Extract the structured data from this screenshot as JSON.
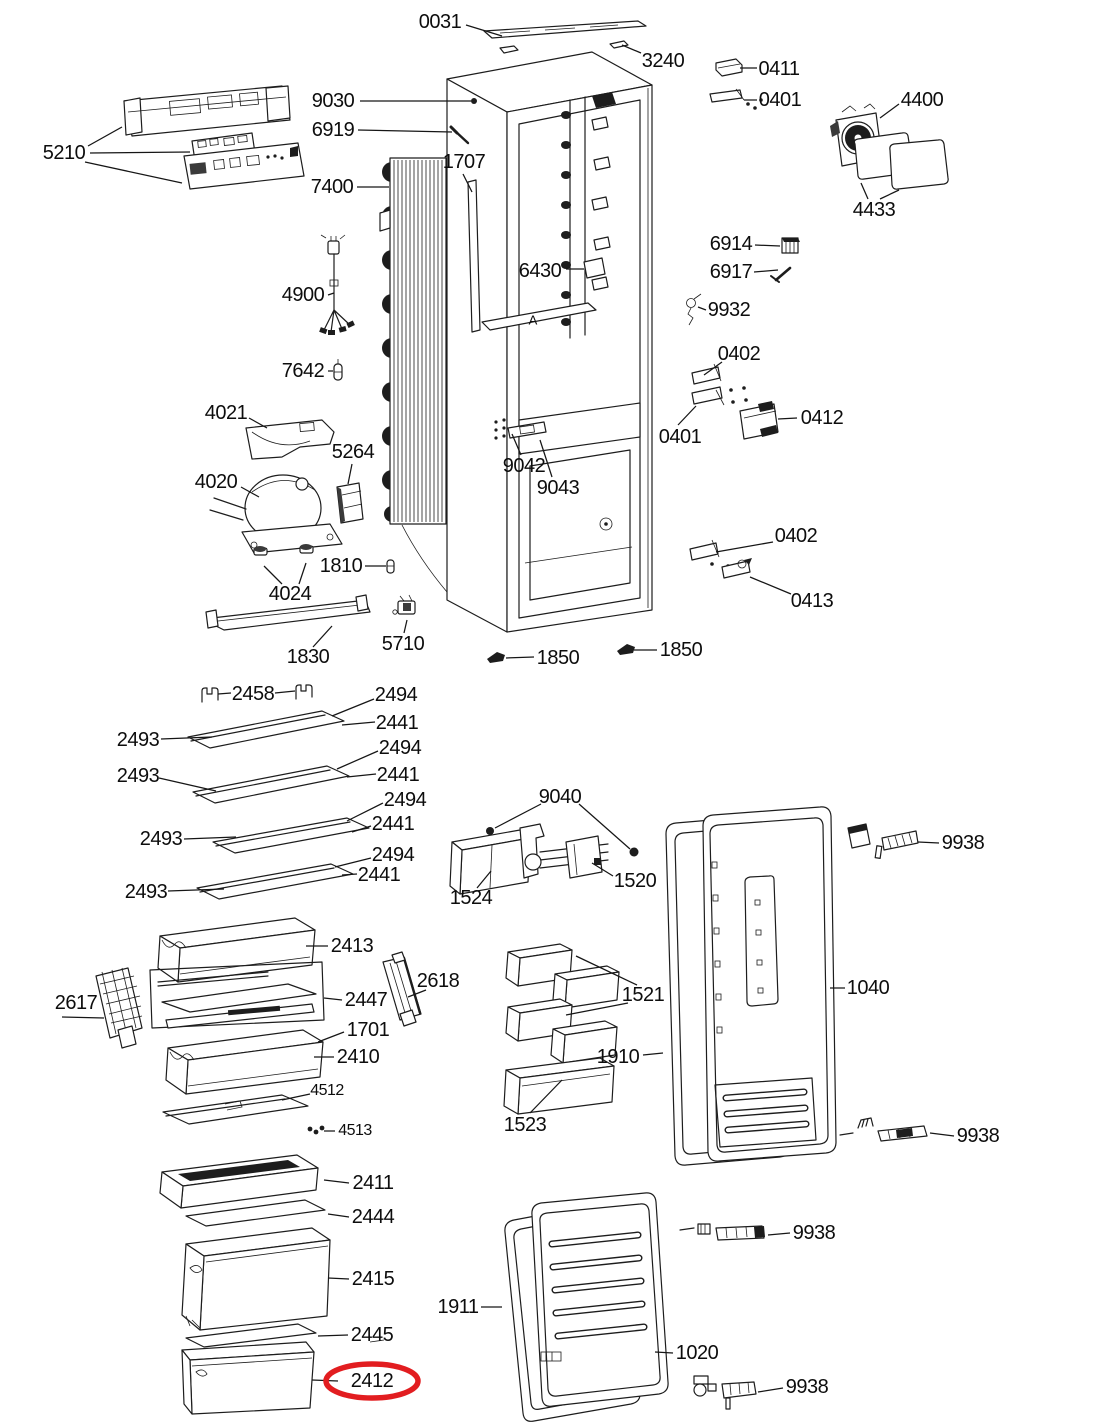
{
  "canvas": {
    "w": 1100,
    "h": 1424,
    "bg": "#ffffff",
    "line_color": "#1d1d1d",
    "label_color": "#0d0d0d",
    "highlight_color": "#e21d20"
  },
  "highlight": {
    "label": "2412",
    "cx": 372,
    "cy": 1381,
    "rx": 46,
    "ry": 17,
    "stroke_width": 5.5
  },
  "annotations": [
    {
      "t": "A",
      "x": 533,
      "y": 320
    }
  ],
  "labels": [
    {
      "t": "0031",
      "x": 440,
      "y": 22,
      "leaders": [
        [
          466,
          25,
          502,
          36
        ]
      ]
    },
    {
      "t": "3240",
      "x": 663,
      "y": 61,
      "leaders": [
        [
          641,
          53,
          622,
          45
        ]
      ]
    },
    {
      "t": "0411",
      "x": 779,
      "y": 69,
      "leaders": [
        [
          757,
          68,
          740,
          68
        ]
      ]
    },
    {
      "t": "0401",
      "x": 780,
      "y": 100,
      "leaders": [
        [
          757,
          100,
          744,
          100
        ]
      ]
    },
    {
      "t": "4400",
      "x": 922,
      "y": 100,
      "leaders": [
        [
          899,
          104,
          880,
          118
        ]
      ]
    },
    {
      "t": "4433",
      "x": 874,
      "y": 210,
      "leaders": [
        [
          868,
          199,
          861,
          183
        ],
        [
          880,
          199,
          899,
          190
        ]
      ]
    },
    {
      "t": "9030",
      "x": 333,
      "y": 101,
      "leaders": [
        [
          360,
          101,
          471,
          101
        ]
      ]
    },
    {
      "t": "6919",
      "x": 333,
      "y": 130,
      "leaders": [
        [
          358,
          130,
          452,
          132
        ]
      ]
    },
    {
      "t": "5210",
      "x": 64,
      "y": 153,
      "leaders": [
        [
          88,
          146,
          122,
          127
        ],
        [
          90,
          153,
          190,
          152
        ],
        [
          85,
          162,
          182,
          183
        ]
      ]
    },
    {
      "t": "7400",
      "x": 332,
      "y": 187,
      "leaders": [
        [
          357,
          187,
          389,
          187
        ]
      ]
    },
    {
      "t": "1707",
      "x": 464,
      "y": 162,
      "leaders": [
        [
          463,
          174,
          472,
          192
        ]
      ]
    },
    {
      "t": "6430",
      "x": 540,
      "y": 271,
      "leaders": [
        [
          566,
          269,
          584,
          269
        ]
      ]
    },
    {
      "t": "6914",
      "x": 731,
      "y": 244,
      "leaders": [
        [
          755,
          245,
          780,
          246
        ]
      ]
    },
    {
      "t": "6917",
      "x": 731,
      "y": 272,
      "leaders": [
        [
          754,
          272,
          778,
          270
        ]
      ]
    },
    {
      "t": "9932",
      "x": 729,
      "y": 310,
      "leaders": [
        [
          706,
          310,
          698,
          307
        ]
      ]
    },
    {
      "t": "4900",
      "x": 303,
      "y": 295,
      "leaders": [
        [
          328,
          295,
          334,
          293
        ]
      ]
    },
    {
      "t": "7642",
      "x": 303,
      "y": 371,
      "leaders": [
        [
          328,
          371,
          333,
          371
        ]
      ]
    },
    {
      "t": "0402",
      "x": 739,
      "y": 354,
      "leaders": [
        [
          722,
          362,
          704,
          375
        ]
      ]
    },
    {
      "t": "0401",
      "x": 680,
      "y": 437,
      "leaders": [
        [
          678,
          425,
          696,
          406
        ]
      ]
    },
    {
      "t": "0412",
      "x": 822,
      "y": 418,
      "leaders": [
        [
          797,
          418,
          778,
          419
        ]
      ]
    },
    {
      "t": "4021",
      "x": 226,
      "y": 413,
      "leaders": [
        [
          249,
          418,
          267,
          428
        ]
      ]
    },
    {
      "t": "5264",
      "x": 353,
      "y": 452,
      "leaders": [
        [
          352,
          464,
          348,
          484
        ]
      ]
    },
    {
      "t": "4020",
      "x": 216,
      "y": 482,
      "leaders": [
        [
          241,
          487,
          259,
          497
        ]
      ]
    },
    {
      "t": "9042",
      "x": 524,
      "y": 466,
      "leaders": [
        [
          521,
          455,
          512,
          434
        ]
      ]
    },
    {
      "t": "9043",
      "x": 558,
      "y": 488,
      "leaders": [
        [
          552,
          477,
          540,
          440
        ]
      ]
    },
    {
      "t": "1810",
      "x": 341,
      "y": 566,
      "leaders": [
        [
          365,
          566,
          386,
          566
        ]
      ]
    },
    {
      "t": "4024",
      "x": 290,
      "y": 594,
      "leaders": [
        [
          282,
          584,
          264,
          566
        ],
        [
          299,
          584,
          306,
          563
        ]
      ]
    },
    {
      "t": "1830",
      "x": 308,
      "y": 657,
      "leaders": [
        [
          313,
          647,
          332,
          626
        ]
      ]
    },
    {
      "t": "5710",
      "x": 403,
      "y": 644,
      "leaders": [
        [
          404,
          633,
          407,
          620
        ]
      ]
    },
    {
      "t": "1850",
      "x": 558,
      "y": 658,
      "leaders": [
        [
          534,
          657,
          506,
          658
        ]
      ]
    },
    {
      "t": "1850",
      "x": 681,
      "y": 650,
      "leaders": [
        [
          657,
          650,
          634,
          650
        ]
      ]
    },
    {
      "t": "0402",
      "x": 796,
      "y": 536,
      "leaders": [
        [
          773,
          542,
          716,
          552
        ]
      ]
    },
    {
      "t": "0413",
      "x": 812,
      "y": 601,
      "leaders": [
        [
          791,
          594,
          750,
          577
        ]
      ]
    },
    {
      "t": "2458",
      "x": 253,
      "y": 694,
      "leaders": [
        [
          231,
          693,
          218,
          694
        ],
        [
          275,
          693,
          295,
          691
        ]
      ]
    },
    {
      "t": "2494",
      "x": 396,
      "y": 695,
      "leaders": [
        [
          374,
          699,
          332,
          716
        ]
      ]
    },
    {
      "t": "2441",
      "x": 397,
      "y": 723,
      "leaders": [
        [
          375,
          722,
          342,
          725
        ]
      ]
    },
    {
      "t": "2493",
      "x": 138,
      "y": 740,
      "leaders": [
        [
          161,
          739,
          212,
          737
        ]
      ]
    },
    {
      "t": "2494",
      "x": 400,
      "y": 748,
      "leaders": [
        [
          378,
          751,
          337,
          769
        ]
      ]
    },
    {
      "t": "2441",
      "x": 398,
      "y": 775,
      "leaders": [
        [
          376,
          774,
          347,
          777
        ]
      ]
    },
    {
      "t": "2493",
      "x": 138,
      "y": 776,
      "leaders": [
        [
          159,
          778,
          216,
          791
        ]
      ]
    },
    {
      "t": "2494",
      "x": 405,
      "y": 800,
      "leaders": [
        [
          383,
          803,
          347,
          821
        ]
      ]
    },
    {
      "t": "2441",
      "x": 393,
      "y": 824,
      "leaders": [
        [
          371,
          826,
          352,
          832
        ]
      ]
    },
    {
      "t": "2493",
      "x": 161,
      "y": 839,
      "leaders": [
        [
          184,
          839,
          236,
          837
        ]
      ]
    },
    {
      "t": "2494",
      "x": 393,
      "y": 855,
      "leaders": [
        [
          371,
          858,
          335,
          867
        ]
      ]
    },
    {
      "t": "2441",
      "x": 379,
      "y": 875,
      "leaders": [
        [
          357,
          874,
          342,
          875
        ]
      ]
    },
    {
      "t": "2493",
      "x": 146,
      "y": 892,
      "leaders": [
        [
          168,
          891,
          224,
          889
        ]
      ]
    },
    {
      "t": "9040",
      "x": 560,
      "y": 797,
      "leaders": [
        [
          541,
          804,
          495,
          828
        ],
        [
          579,
          804,
          630,
          849
        ]
      ]
    },
    {
      "t": "1524",
      "x": 471,
      "y": 898,
      "leaders": [
        [
          477,
          888,
          491,
          871
        ]
      ]
    },
    {
      "t": "1520",
      "x": 635,
      "y": 881,
      "leaders": [
        [
          613,
          876,
          592,
          863
        ]
      ]
    },
    {
      "t": "9938",
      "x": 963,
      "y": 843,
      "leaders": [
        [
          939,
          843,
          918,
          842
        ]
      ]
    },
    {
      "t": "2413",
      "x": 352,
      "y": 946,
      "leaders": [
        [
          328,
          946,
          306,
          946
        ]
      ]
    },
    {
      "t": "2618",
      "x": 438,
      "y": 981,
      "leaders": [
        [
          426,
          990,
          408,
          997
        ]
      ]
    },
    {
      "t": "2617",
      "x": 76,
      "y": 1003,
      "leaders": [
        [
          62,
          1017,
          104,
          1018
        ]
      ]
    },
    {
      "t": "2447",
      "x": 366,
      "y": 1000,
      "leaders": [
        [
          342,
          1000,
          324,
          998
        ]
      ]
    },
    {
      "t": "1701",
      "x": 368,
      "y": 1030,
      "leaders": [
        [
          344,
          1032,
          318,
          1042
        ]
      ]
    },
    {
      "t": "2410",
      "x": 358,
      "y": 1057,
      "leaders": [
        [
          334,
          1057,
          314,
          1057
        ]
      ]
    },
    {
      "t": "1521",
      "x": 643,
      "y": 995,
      "leaders": [
        [
          637,
          985,
          576,
          956
        ],
        [
          628,
          1003,
          566,
          1015
        ]
      ]
    },
    {
      "t": "1910",
      "x": 618,
      "y": 1057,
      "leaders": [
        [
          643,
          1055,
          663,
          1053
        ]
      ]
    },
    {
      "t": "1040",
      "x": 868,
      "y": 988,
      "leaders": [
        [
          845,
          988,
          830,
          988
        ]
      ]
    },
    {
      "t": "4512",
      "x": 327,
      "y": 1091,
      "size": 16,
      "leaders": [
        [
          310,
          1094,
          282,
          1100
        ]
      ]
    },
    {
      "t": "4513",
      "x": 355,
      "y": 1131,
      "size": 16,
      "leaders": [
        [
          335,
          1131,
          324,
          1131
        ]
      ]
    },
    {
      "t": "1523",
      "x": 525,
      "y": 1125,
      "leaders": [
        [
          530,
          1113,
          562,
          1080
        ]
      ]
    },
    {
      "t": "9938",
      "x": 978,
      "y": 1136,
      "leaders": [
        [
          954,
          1136,
          930,
          1133
        ]
      ]
    },
    {
      "t": "2411",
      "x": 373,
      "y": 1183,
      "leaders": [
        [
          349,
          1183,
          324,
          1180
        ]
      ]
    },
    {
      "t": "2444",
      "x": 373,
      "y": 1217,
      "leaders": [
        [
          349,
          1217,
          328,
          1214
        ]
      ]
    },
    {
      "t": "2415",
      "x": 373,
      "y": 1279,
      "leaders": [
        [
          349,
          1279,
          328,
          1278
        ]
      ]
    },
    {
      "t": "1911",
      "x": 458,
      "y": 1307,
      "leaders": [
        [
          481,
          1307,
          502,
          1307
        ]
      ]
    },
    {
      "t": "9938",
      "x": 814,
      "y": 1233,
      "leaders": [
        [
          790,
          1233,
          768,
          1235
        ]
      ]
    },
    {
      "t": "2445",
      "x": 372,
      "y": 1335,
      "leaders": [
        [
          348,
          1335,
          318,
          1336
        ]
      ]
    },
    {
      "t": "2412",
      "x": 372,
      "y": 1381,
      "leaders": [
        [
          338,
          1381,
          312,
          1380
        ]
      ]
    },
    {
      "t": "1020",
      "x": 697,
      "y": 1353,
      "leaders": [
        [
          673,
          1353,
          655,
          1352
        ]
      ]
    },
    {
      "t": "9938",
      "x": 807,
      "y": 1387,
      "leaders": [
        [
          783,
          1388,
          758,
          1392
        ]
      ]
    }
  ]
}
